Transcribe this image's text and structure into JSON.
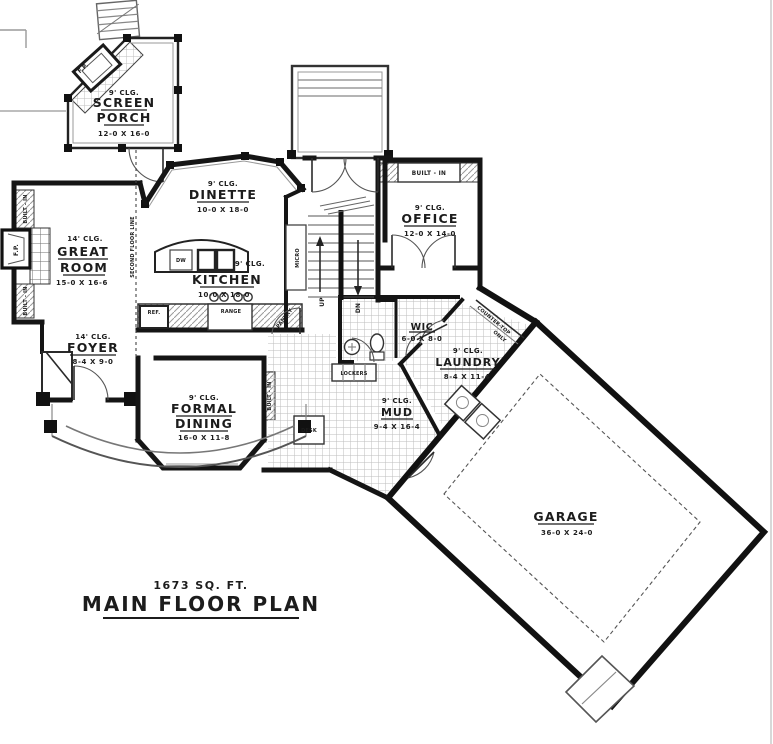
{
  "plan": {
    "area_label": "1673 SQ. FT.",
    "title": "MAIN FLOOR PLAN"
  },
  "rooms": {
    "screen_porch": {
      "ceiling": "9' CLG.",
      "name_line1": "SCREEN",
      "name_line2": "PORCH",
      "dims": "12-0 X 16-0"
    },
    "dinette": {
      "ceiling": "9' CLG.",
      "name": "DINETTE",
      "dims": "10-0 X 18-0"
    },
    "kitchen": {
      "ceiling": "9' CLG.",
      "name": "KITCHEN",
      "dims": "10-0 X 18-0"
    },
    "great_room": {
      "ceiling": "14' CLG.",
      "name_line1": "GREAT",
      "name_line2": "ROOM",
      "dims": "15-0 X 16-6"
    },
    "foyer": {
      "ceiling": "14' CLG.",
      "name": "FOYER",
      "dims": "8-4 X 9-0"
    },
    "formal_dining": {
      "ceiling": "9' CLG.",
      "name_line1": "FORMAL",
      "name_line2": "DINING",
      "dims": "16-0 X 11-8"
    },
    "office": {
      "ceiling": "9' CLG.",
      "name": "OFFICE",
      "dims": "12-0 X 14-0"
    },
    "wic": {
      "name": "WIC",
      "dims": "6-0 X 8-0"
    },
    "laundry": {
      "ceiling": "9' CLG.",
      "name": "LAUNDRY",
      "dims": "8-4 X 11-4"
    },
    "mud": {
      "ceiling": "9' CLG.",
      "name": "MUD",
      "dims": "9-4 X 16-4"
    },
    "garage": {
      "name": "GARAGE",
      "dims": "36-0 X 24-0"
    }
  },
  "labels": {
    "second_floor_line": "SECOND FLOOR LINE",
    "built_in": "BUILT - IN",
    "fp": "F.P.",
    "micro": "MICRO",
    "up": "UP",
    "dn": "DN",
    "ref": "REF.",
    "range": "RANGE",
    "dw": "DW",
    "pantry": "PANTRY",
    "lockers": "LOCKERS",
    "desk": "DESK",
    "countertop_line1": "COUNTER-TOP",
    "countertop_line2": "ONLY"
  },
  "colors": {
    "wall": "#151515",
    "background": "#ffffff",
    "tile": "#b9b9b9"
  }
}
